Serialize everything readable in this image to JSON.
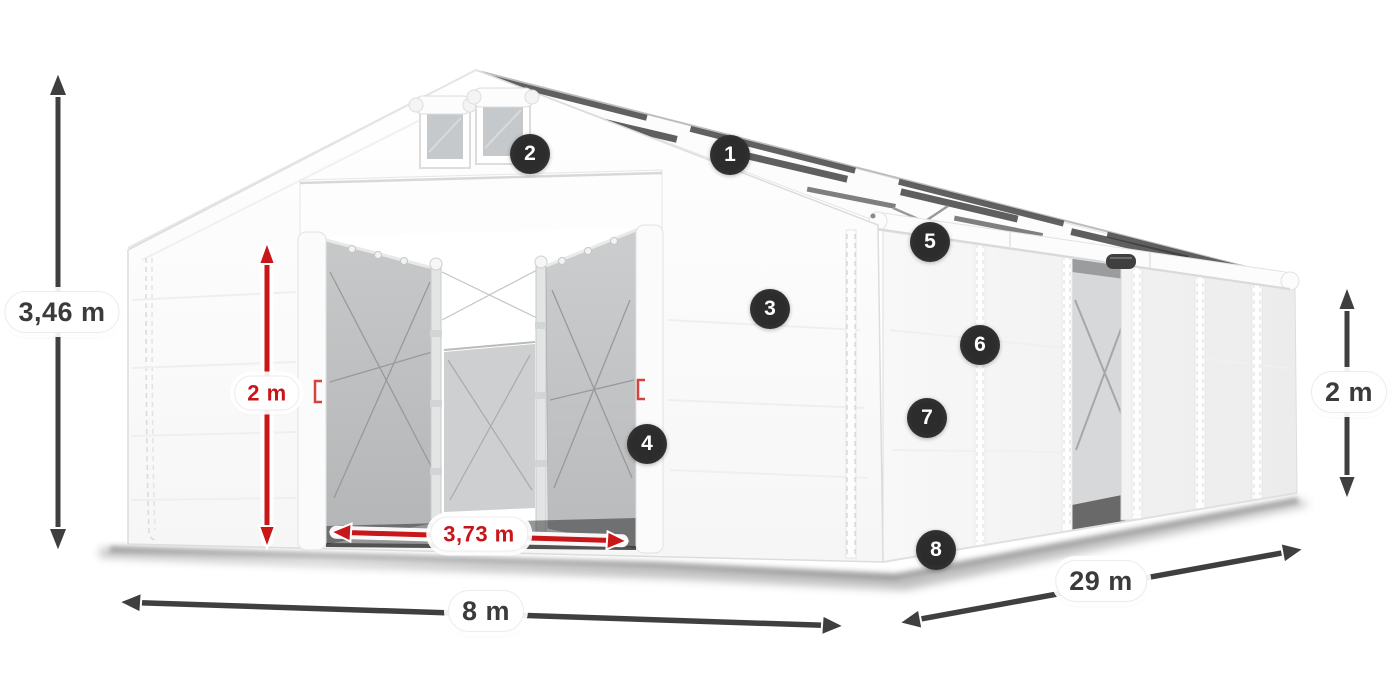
{
  "diagram": {
    "subject": "storage tent with dimension annotations",
    "dimensions": [
      {
        "id": "total-height",
        "label": "3,46 m",
        "color": "dark"
      },
      {
        "id": "entrance-height",
        "label": "2 m",
        "color": "red"
      },
      {
        "id": "entrance-width",
        "label": "3,73 m",
        "color": "red"
      },
      {
        "id": "tent-width",
        "label": "8 m",
        "color": "dark"
      },
      {
        "id": "tent-length",
        "label": "29 m",
        "color": "dark"
      },
      {
        "id": "side-height",
        "label": "2 m",
        "color": "dark"
      }
    ],
    "markers": [
      {
        "number": "1"
      },
      {
        "number": "2"
      },
      {
        "number": "3"
      },
      {
        "number": "4"
      },
      {
        "number": "5"
      },
      {
        "number": "6"
      },
      {
        "number": "7"
      },
      {
        "number": "8"
      }
    ],
    "colors": {
      "accent_red": "#c8151b",
      "dimension_dark": "#3f3f3f",
      "badge_background": "#2c2c2c",
      "badge_text": "#ffffff"
    }
  }
}
